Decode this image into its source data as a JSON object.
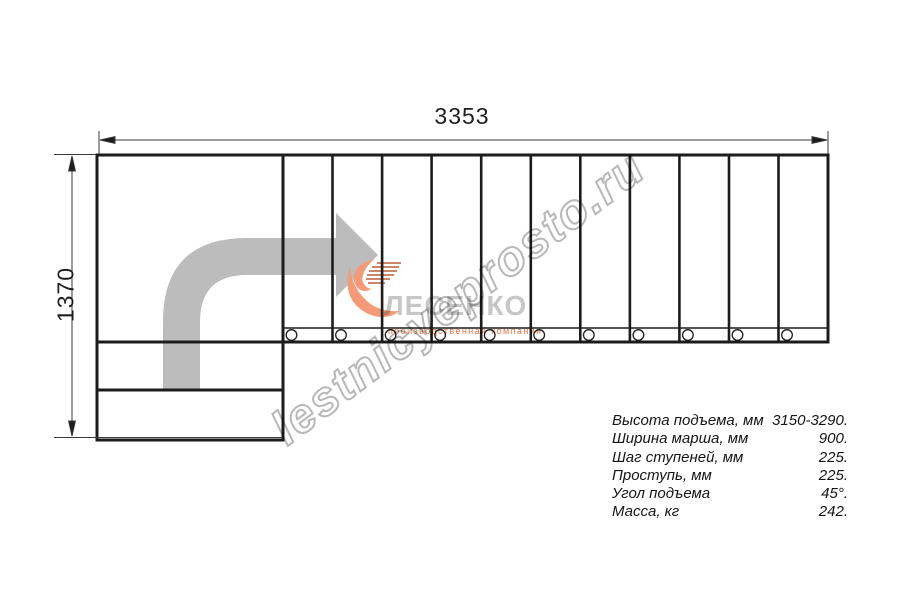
{
  "drawing": {
    "dim_width_label": "3353",
    "dim_height_label": "1370",
    "watermark_text": "lestnicyeprosto.ru",
    "logo": {
      "name": "ЛЕСЕНКО",
      "subtitle": "производственная компания"
    },
    "stairs": {
      "tread_count": 11,
      "baluster_count": 11,
      "landing_steps": 2,
      "direction_arrow": "turn-right-then-straight"
    },
    "colors": {
      "line": "#1c1c1c",
      "arrow_gray": "#bcbcbc",
      "watermark_gray": "#a6a6a6",
      "logo_salmon": "#f49a77",
      "logo_accent_dark": "#bb5e3a",
      "logo_text_gray": "#c7c7c7",
      "subtitle_orange": "#e87840"
    },
    "specs": {
      "rows": [
        {
          "label": "Высота подъема, мм",
          "value": "3150-3290."
        },
        {
          "label": "Ширина марша, мм",
          "value": "900."
        },
        {
          "label": "Шаг ступеней, мм",
          "value": "225."
        },
        {
          "label": "Проступь, мм",
          "value": "225."
        },
        {
          "label": "Угол подъема",
          "value": "45°."
        },
        {
          "label": "Масса, кг",
          "value": "242."
        }
      ]
    }
  }
}
